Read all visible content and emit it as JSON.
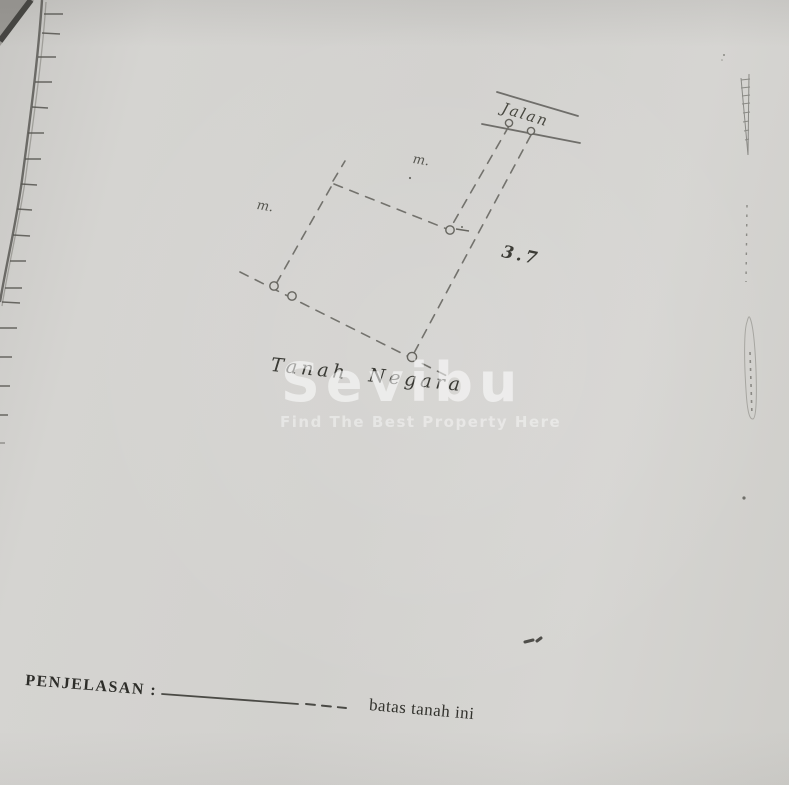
{
  "page": {
    "paper_color": "#d4d3d0",
    "ink_color": "#3a3a36",
    "pencil_color": "#75746f"
  },
  "sketch": {
    "road_label": "Jalan",
    "meter_label_top": "m.",
    "meter_label_left": "m.",
    "frontage_value": "3.7",
    "land_label": "Tanah Negara"
  },
  "watermark": {
    "brand": "Sevibu",
    "tagline": "Find The Best Property Here",
    "color_hex": "#ffffff"
  },
  "legend": {
    "heading": "PENJELASAN :",
    "dashed_meaning": "batas tanah ini"
  }
}
